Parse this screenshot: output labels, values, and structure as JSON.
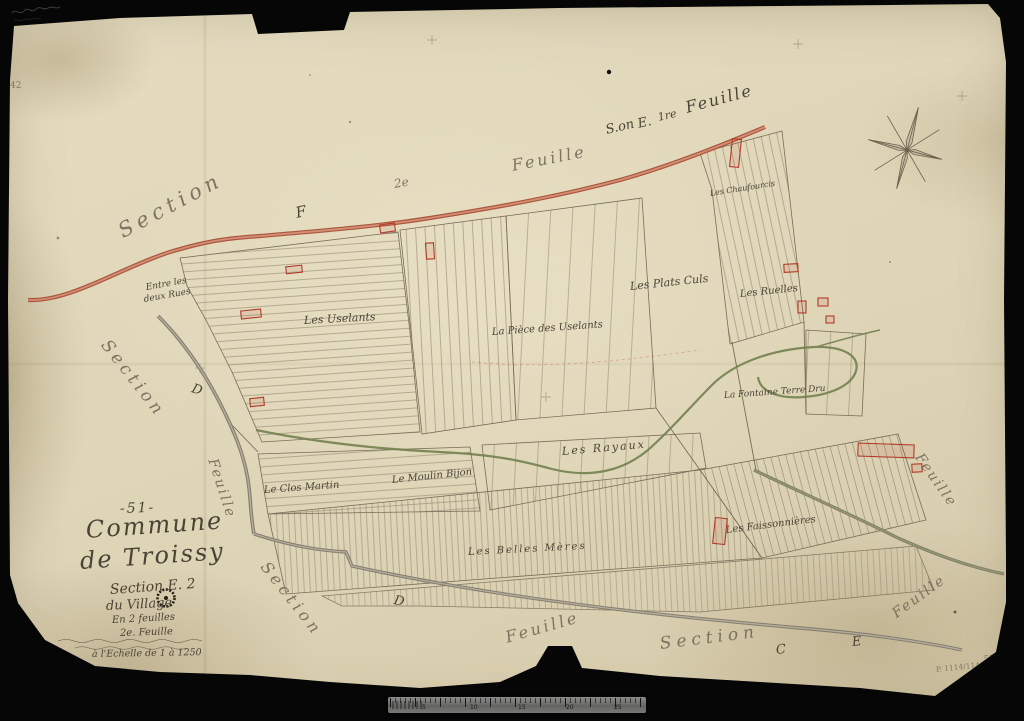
{
  "scan": {
    "background_color": "#060606",
    "paper_color": "#e0d7ba",
    "ink_color": "#4a4336",
    "red_road_color": "#b0523b",
    "green_water_color": "#73814f",
    "grey_road_color": "#857d6e"
  },
  "ruler": {
    "numbers": [
      "5",
      "10",
      "15",
      "20",
      "25"
    ]
  },
  "labels": [
    {
      "name": "edge-section-top-left",
      "group": "sheet-edge",
      "text": "Section",
      "x": 120,
      "y": 222,
      "rot": -28,
      "size": 21,
      "ls": 5,
      "cls": "faint"
    },
    {
      "name": "edge-letter-f",
      "group": "sheet-edge",
      "text": "F",
      "x": 296,
      "y": 206,
      "rot": -12,
      "size": 15
    },
    {
      "name": "edge-2e",
      "group": "sheet-edge",
      "text": "2e",
      "x": 394,
      "y": 178,
      "rot": -10,
      "size": 12,
      "cls": "faint"
    },
    {
      "name": "edge-feuille-top",
      "group": "sheet-edge",
      "text": "Feuille",
      "x": 512,
      "y": 158,
      "rot": -11,
      "size": 16,
      "ls": 3,
      "cls": "faint"
    },
    {
      "name": "edge-son",
      "group": "sheet-edge",
      "text": "S.on",
      "x": 606,
      "y": 124,
      "rot": -13,
      "size": 13
    },
    {
      "name": "edge-letter-e-top",
      "group": "sheet-edge",
      "text": "E.",
      "x": 638,
      "y": 118,
      "rot": -13,
      "size": 13
    },
    {
      "name": "edge-1re",
      "group": "sheet-edge",
      "text": "1re",
      "x": 658,
      "y": 112,
      "rot": -13,
      "size": 11
    },
    {
      "name": "edge-feuille-top-right",
      "group": "sheet-edge",
      "text": "Feuille",
      "x": 686,
      "y": 100,
      "rot": -15,
      "size": 16,
      "ls": 2
    },
    {
      "name": "edge-section-left",
      "group": "sheet-edge",
      "text": "Section",
      "x": 104,
      "y": 334,
      "rot": 52,
      "size": 17,
      "ls": 4,
      "cls": "faint"
    },
    {
      "name": "edge-letter-d-left",
      "group": "sheet-edge",
      "text": "D",
      "x": 192,
      "y": 382,
      "rot": 18,
      "size": 13
    },
    {
      "name": "edge-feuille-left",
      "group": "sheet-edge",
      "text": "Feuille",
      "x": 212,
      "y": 452,
      "rot": 72,
      "size": 14,
      "ls": 2,
      "cls": "faint"
    },
    {
      "name": "edge-section-bottom-left",
      "group": "sheet-edge",
      "text": "Section",
      "x": 264,
      "y": 556,
      "rot": 52,
      "size": 16,
      "ls": 4,
      "cls": "faint"
    },
    {
      "name": "edge-letter-d-bottom",
      "group": "sheet-edge",
      "text": "D",
      "x": 394,
      "y": 594,
      "rot": 12,
      "size": 13
    },
    {
      "name": "edge-feuille-bottom",
      "group": "sheet-edge",
      "text": "Feuille",
      "x": 506,
      "y": 630,
      "rot": -16,
      "size": 16,
      "ls": 3,
      "cls": "faint"
    },
    {
      "name": "edge-section-bottom",
      "group": "sheet-edge",
      "text": "Section",
      "x": 660,
      "y": 636,
      "rot": -7,
      "size": 17,
      "ls": 5,
      "cls": "faint"
    },
    {
      "name": "edge-letter-c-bottom",
      "group": "sheet-edge",
      "text": "C",
      "x": 776,
      "y": 644,
      "rot": -6,
      "size": 13
    },
    {
      "name": "edge-letter-e-bottom",
      "group": "sheet-edge",
      "text": "E",
      "x": 852,
      "y": 636,
      "rot": -6,
      "size": 13
    },
    {
      "name": "edge-feuille-bottom-right",
      "group": "sheet-edge",
      "text": "Feuille",
      "x": 894,
      "y": 608,
      "rot": -36,
      "size": 14,
      "ls": 2,
      "cls": "faint"
    },
    {
      "name": "edge-feuille-right",
      "group": "sheet-edge",
      "text": "Feuille",
      "x": 918,
      "y": 448,
      "rot": 55,
      "size": 14,
      "ls": 2,
      "cls": "faint"
    },
    {
      "name": "placename-entre-les-deux-rues-1",
      "group": "placenames",
      "text": "Entre les",
      "x": 146,
      "y": 284,
      "rot": -10,
      "size": 9
    },
    {
      "name": "placename-entre-les-deux-rues-2",
      "group": "placenames",
      "text": "deux Rues",
      "x": 144,
      "y": 296,
      "rot": -10,
      "size": 9
    },
    {
      "name": "placename-les-uselants",
      "group": "placenames",
      "text": "Les Uselants",
      "x": 304,
      "y": 315,
      "rot": -3,
      "size": 11
    },
    {
      "name": "placename-la-piece-des-uselants",
      "group": "placenames",
      "text": "La Pièce des Uselants",
      "x": 492,
      "y": 328,
      "rot": -4,
      "size": 10
    },
    {
      "name": "placename-les-plats-culs",
      "group": "placenames",
      "text": "Les Plats Culs",
      "x": 630,
      "y": 281,
      "rot": -6,
      "size": 11
    },
    {
      "name": "placename-les-ruelles",
      "group": "placenames",
      "text": "Les Ruelles",
      "x": 740,
      "y": 290,
      "rot": -6,
      "size": 10
    },
    {
      "name": "placename-les-chaufourcis",
      "group": "placenames",
      "text": "Les Chaufourcis",
      "x": 710,
      "y": 190,
      "rot": -9,
      "size": 8
    },
    {
      "name": "placename-la-fontaine-terre-dru",
      "group": "placenames",
      "text": "La Fontaine Terre Dru",
      "x": 724,
      "y": 392,
      "rot": -4,
      "size": 9
    },
    {
      "name": "placename-les-rayaux",
      "group": "placenames",
      "text": "Les Rayaux",
      "x": 562,
      "y": 446,
      "rot": -5,
      "size": 11,
      "ls": 2
    },
    {
      "name": "placename-le-clos-martin",
      "group": "placenames",
      "text": "Le Clos Martin",
      "x": 264,
      "y": 486,
      "rot": -4,
      "size": 10
    },
    {
      "name": "placename-le-moulin-bijon",
      "group": "placenames",
      "text": "Le Moulin Bijon",
      "x": 392,
      "y": 476,
      "rot": -6,
      "size": 10
    },
    {
      "name": "placename-les-belles-meres",
      "group": "placenames",
      "text": "Les Belles Mères",
      "x": 468,
      "y": 548,
      "rot": -3,
      "size": 10,
      "ls": 2
    },
    {
      "name": "placename-les-faissonnieres",
      "group": "placenames",
      "text": "Les Faissonnières",
      "x": 726,
      "y": 526,
      "rot": -7,
      "size": 10
    },
    {
      "name": "title-sheet-number",
      "group": "title-block",
      "text": "-51-",
      "x": 120,
      "y": 502,
      "rot": -2,
      "size": 14,
      "ls": 2
    },
    {
      "name": "title-commune",
      "group": "title-block",
      "text": "Commune",
      "x": 86,
      "y": 518,
      "rot": -4,
      "size": 24,
      "ls": 2
    },
    {
      "name": "title-place",
      "group": "title-block",
      "text": "de Troissy",
      "x": 80,
      "y": 549,
      "rot": -4,
      "size": 24,
      "ls": 2
    },
    {
      "name": "title-section",
      "group": "title-block",
      "text": "Section E. 2",
      "x": 110,
      "y": 583,
      "rot": -4,
      "size": 14
    },
    {
      "name": "title-part",
      "group": "title-block",
      "text": "du Village",
      "x": 106,
      "y": 600,
      "rot": -3,
      "size": 13
    },
    {
      "name": "title-feuilles",
      "group": "title-block",
      "text": "En 2 feuilles",
      "x": 112,
      "y": 616,
      "rot": -3,
      "size": 10
    },
    {
      "name": "title-feuille-no",
      "group": "title-block",
      "text": "2e. Feuille",
      "x": 120,
      "y": 629,
      "rot": -2,
      "size": 10
    },
    {
      "name": "title-scale",
      "group": "title-block",
      "text": "à l'Echelle de 1 à 1250",
      "x": 92,
      "y": 650,
      "rot": -1,
      "size": 9.5
    },
    {
      "name": "mark-top-left",
      "group": "marks",
      "text": "42",
      "x": 10,
      "y": 82,
      "rot": 0,
      "size": 9,
      "cls": "mark"
    },
    {
      "name": "mark-archive-number",
      "group": "marks",
      "text": "P. 1114/1144",
      "x": 936,
      "y": 666,
      "rot": -6,
      "size": 7.5,
      "cls": "mark"
    },
    {
      "name": "mark-archive-52",
      "group": "marks",
      "text": "52",
      "x": 984,
      "y": 656,
      "rot": -6,
      "size": 9,
      "cls": "mark"
    }
  ]
}
